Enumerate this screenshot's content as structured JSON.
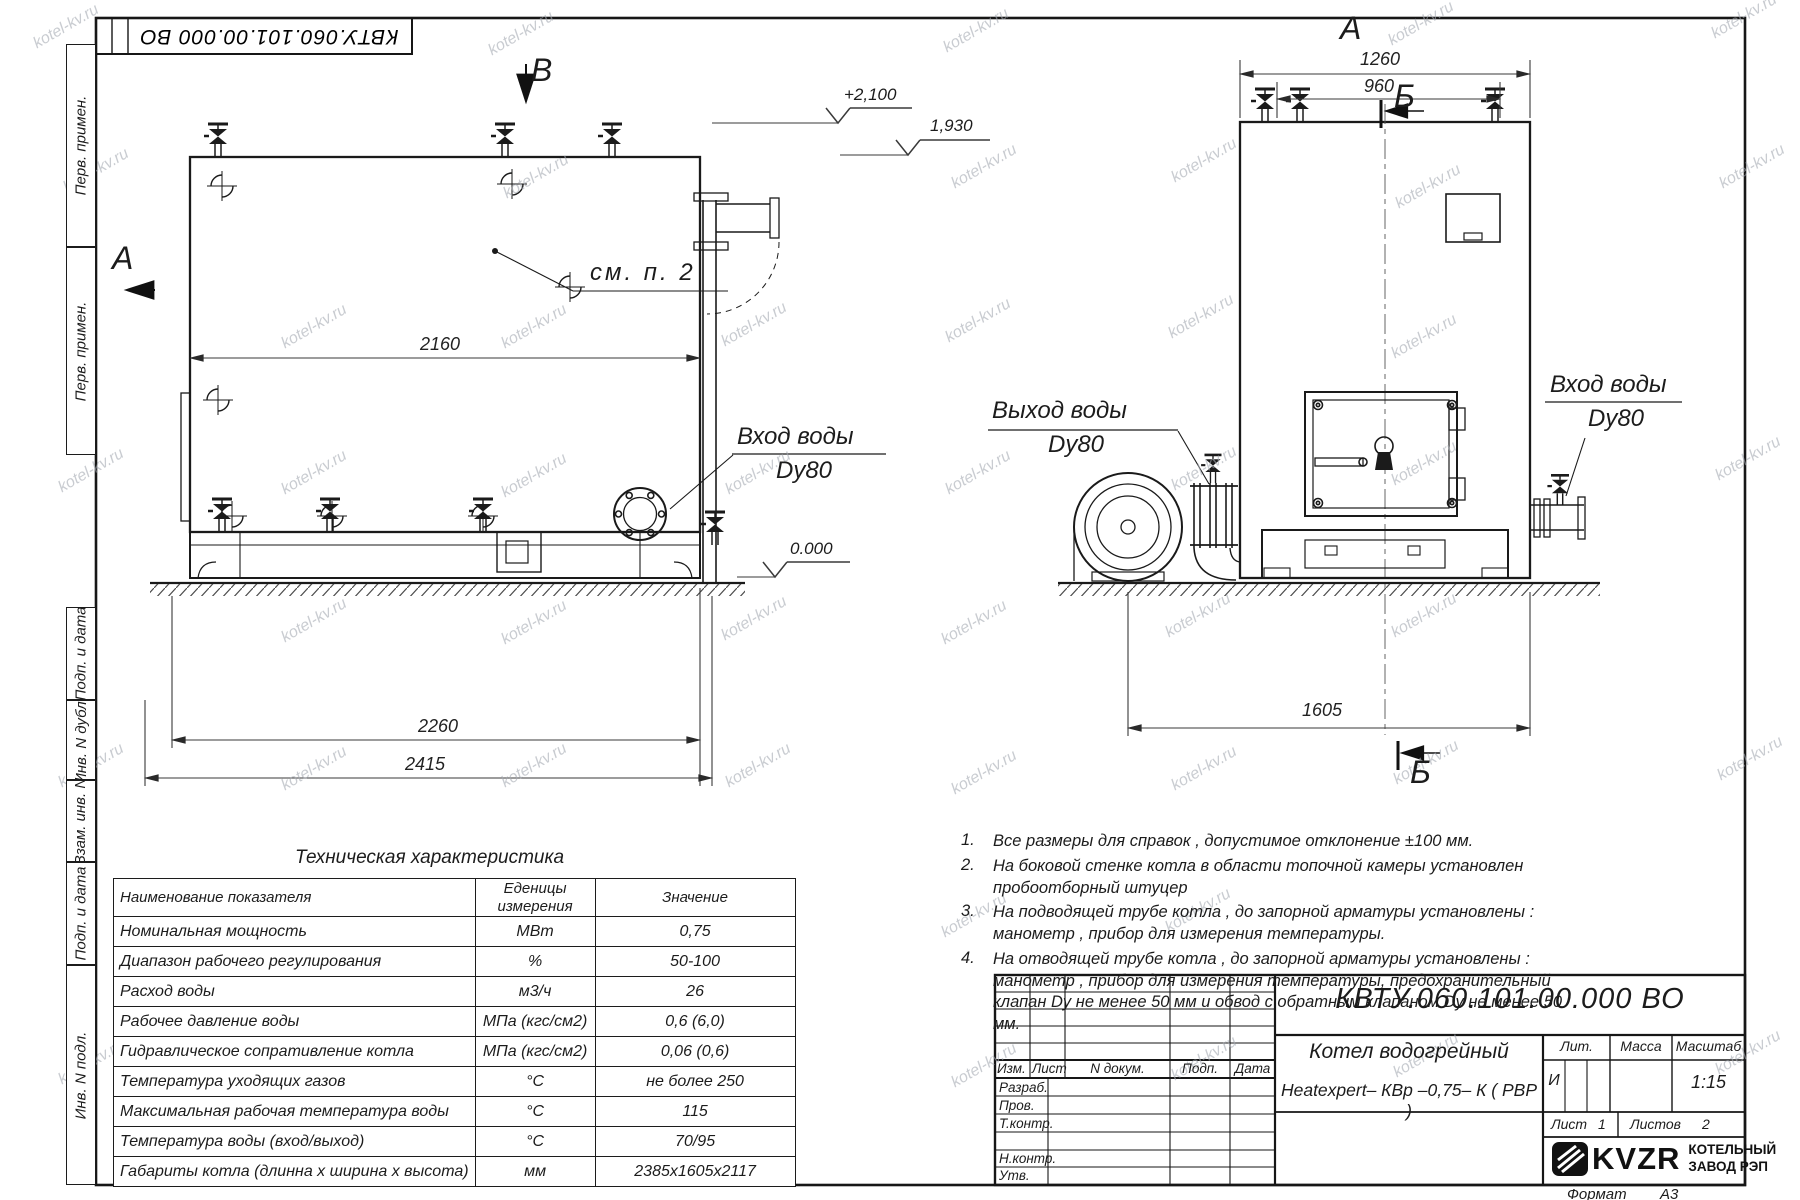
{
  "watermark": {
    "text": "kotel-kv.ru"
  },
  "corner_stamp": {
    "doc_number": "КВТУ.060.101.00.000  ВО"
  },
  "side_strip": {
    "labels": [
      "Перв. примен.",
      "Перв. примен.",
      "Подп. и дата",
      "Инв. N дубл.",
      "Взам. инв. N",
      "Подп. и дата",
      "Инв. N подл."
    ]
  },
  "left_view": {
    "section_mark_top": "В",
    "view_mark_left": "А",
    "note_ref": "см. п. 2",
    "dim_body_length": "2160",
    "dim_skid_length": "2260",
    "dim_overall_length": "2415",
    "elevation_top": "+2,100",
    "elevation_boiler_top": "1,930",
    "elevation_ground": "0.000",
    "water_inlet_label": "Вход воды",
    "water_inlet_dn": "Dy80"
  },
  "right_view": {
    "view_mark_top": "А",
    "section_mark_top": "Б",
    "section_mark_bottom": "Б",
    "dim_valves_outer": "1260",
    "dim_valves_inner": "960",
    "dim_width": "1605",
    "water_outlet_label": "Выход воды",
    "water_outlet_dn": "Dy80",
    "water_inlet_label": "Вход воды",
    "water_inlet_dn": "Dy80"
  },
  "tech_table": {
    "title": "Техническая характеристика",
    "col_name": "Наименование показателя",
    "col_units": "Еденицы\nизмерения",
    "col_value": "Значение",
    "rows": [
      {
        "name": "Номинальная мощность",
        "units": "МВт",
        "value": "0,75"
      },
      {
        "name": "Диапазон рабочего регулирования",
        "units": "%",
        "value": "50-100"
      },
      {
        "name": "Расход воды",
        "units": "м3/ч",
        "value": "26"
      },
      {
        "name": "Рабочее давление воды",
        "units": "МПа (кгс/см2)",
        "value": "0,6 (6,0)"
      },
      {
        "name": "Гидравлическое сопративление котла",
        "units": "МПа (кгс/см2)",
        "value": "0,06 (0,6)"
      },
      {
        "name": "Температура уходящих газов",
        "units": "°С",
        "value": "не более 250"
      },
      {
        "name": "Максимальная рабочая температура воды",
        "units": "°С",
        "value": "115"
      },
      {
        "name": "Температура воды (вход/выход)",
        "units": "°С",
        "value": "70/95"
      },
      {
        "name": "Габариты котла (длинна х ширина х высота)",
        "units": "мм",
        "value": "2385х1605х2117"
      }
    ]
  },
  "notes": [
    {
      "num": "1.",
      "text": "Все размеры для справок , допустимое отклонение  ±100 мм."
    },
    {
      "num": "2.",
      "text": "На боковой стенке котла в области топочной камеры установлен пробоотборный штуцер"
    },
    {
      "num": "3.",
      "text": "На   подводящей трубе котла , до запорной арматуры установлены :  манометр ,  прибор для измерения температуры."
    },
    {
      "num": "4.",
      "text": "На отводящей трубе котла , до запорной арматуры установлены :  манометр , прибор для измерения температуры, предохранительный клапан  Dу не менее  50 мм и обвод с обратным клапаном  Dу не менее  50 мм."
    }
  ],
  "title_block": {
    "doc_number": "КВТУ.060.101.00.000  ВО",
    "product_name_line1": "Котел водогрейный",
    "product_name_line2": "Heatexpert– КВр –0,75– К ( РВР )",
    "col_izm": "Изм.",
    "col_list": "Лист",
    "col_doc": "N докум.",
    "col_sign": "Подп.",
    "col_date": "Дата",
    "row_developed": "Разраб.",
    "row_checked": "Пров.",
    "row_tcontrol": "Т.контр.",
    "row_ncontrol": "Н.контр.",
    "row_approved": "Утв.",
    "lit_label": "Лит.",
    "lit_value": "И",
    "mass_label": "Масса",
    "scale_label": "Масштаб",
    "scale_value": "1:15",
    "sheet_label": "Лист",
    "sheet_value": "1",
    "sheets_label": "Листов",
    "sheets_value": "2",
    "logo_text": "KVZR",
    "company_line1": "КОТЕЛЬНЫЙ",
    "company_line2": "ЗАВОД РЭП",
    "format_label": "Формат",
    "format_value": "А3"
  }
}
